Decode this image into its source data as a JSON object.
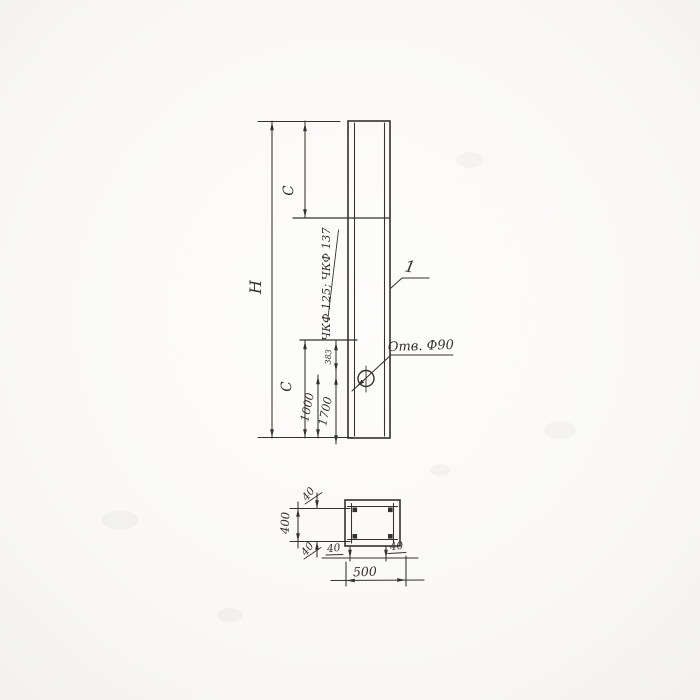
{
  "drawing": {
    "elevation": {
      "height_label": "H",
      "top_offset_label": "C",
      "bottom_offset_label": "C",
      "dim_1000": "1000",
      "dim_1700": "1700",
      "dim_small": "383",
      "zone_mark": "ЧКФ 125; ЧКФ 137",
      "part_callout": "1",
      "hole_note": "Отв. Ф90"
    },
    "section": {
      "cover_top": "40",
      "cover_bottom": "40",
      "cover_left": "40",
      "cover_right": "40",
      "height_between": "400",
      "width_total": "500"
    },
    "colors": {
      "ink": "#35322d",
      "paper": "#fbfaf8"
    }
  }
}
